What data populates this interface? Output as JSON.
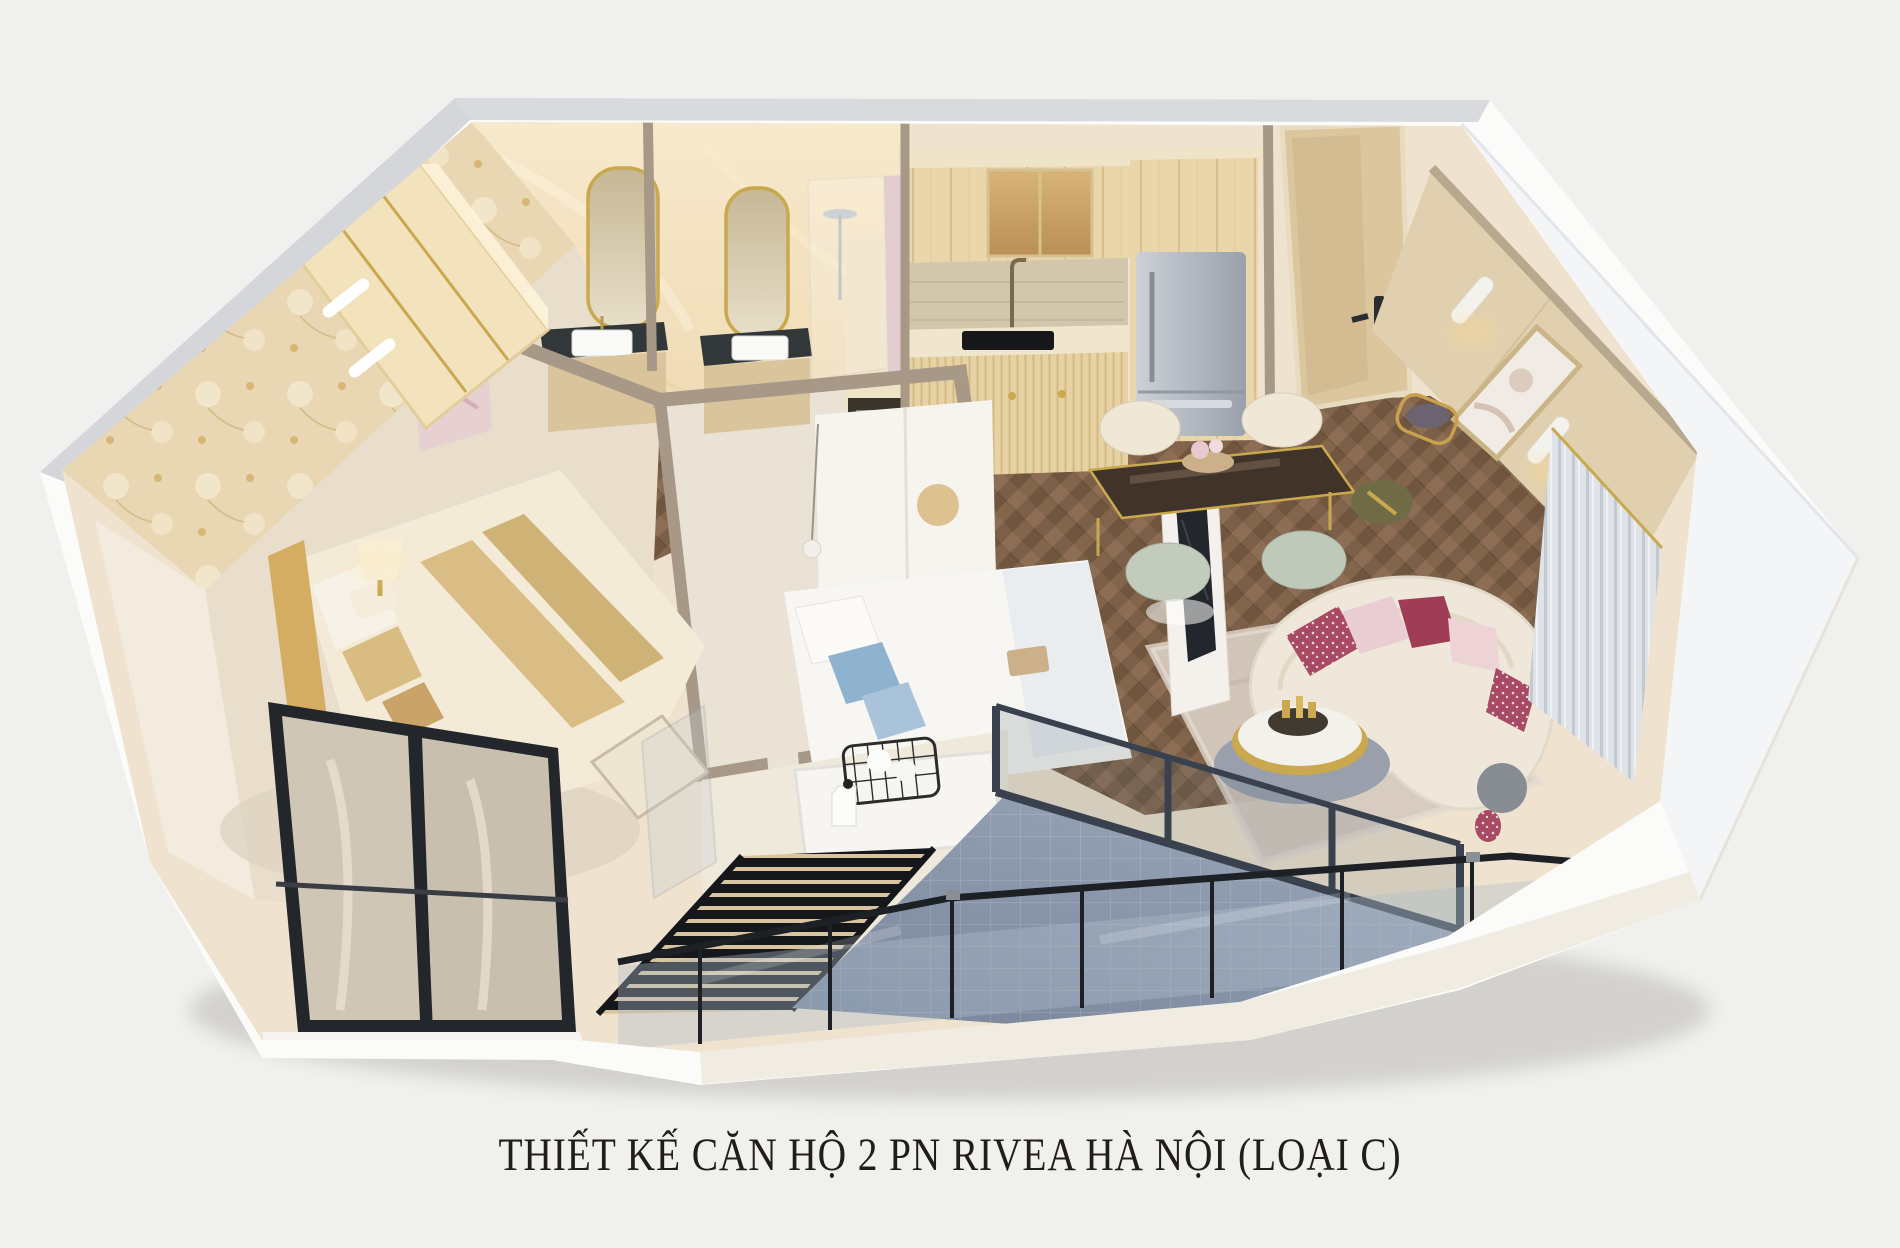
{
  "caption": {
    "title": "THIẾT KẾ CĂN HỘ 2 PN RIVEA HÀ NỘI (LOẠI C)"
  },
  "palette": {
    "background": "#f0f0ee",
    "exterior_wall": "#fbfbfa",
    "exterior_wall_right": "#f4f5f7",
    "wall_top_edge": "#d8dade",
    "interior_base": "#efe3cf",
    "marble_wall": "#f3e2c2",
    "floral_wall_base": "#eddfc0",
    "wood_floor": "#7d6049",
    "bedroom_carpet": "#e8decb",
    "bed2_floor": "#eae3d5",
    "kitchen_cabinet": "#e9d6ab",
    "backsplash": "#d2c6ad",
    "fridge": "#b9bec7",
    "balcony_tile": "#8e9cb0",
    "sofa": "#efe8da",
    "pillow_accent": "#a84a63",
    "gold_accent": "#c9a84e",
    "glass_railing": "#aebdca",
    "curtain": "#dfe3e7",
    "door_wood": "#dbc69e",
    "right_wall_wood": "#e0d0b0",
    "louver_dark": "#15171b",
    "washer_white": "#f6f5f2",
    "wall_cut": "#a79887",
    "window_frame": "#23262b",
    "white_closet": "#f6f4ef",
    "tv_screen": "#23262c",
    "dining_table_top": "#3f332a",
    "sage_chair": "#c2cbbc",
    "cream_chair": "#efe8d6",
    "rug_living": "#d6cabf",
    "caption_color": "#221d19"
  }
}
